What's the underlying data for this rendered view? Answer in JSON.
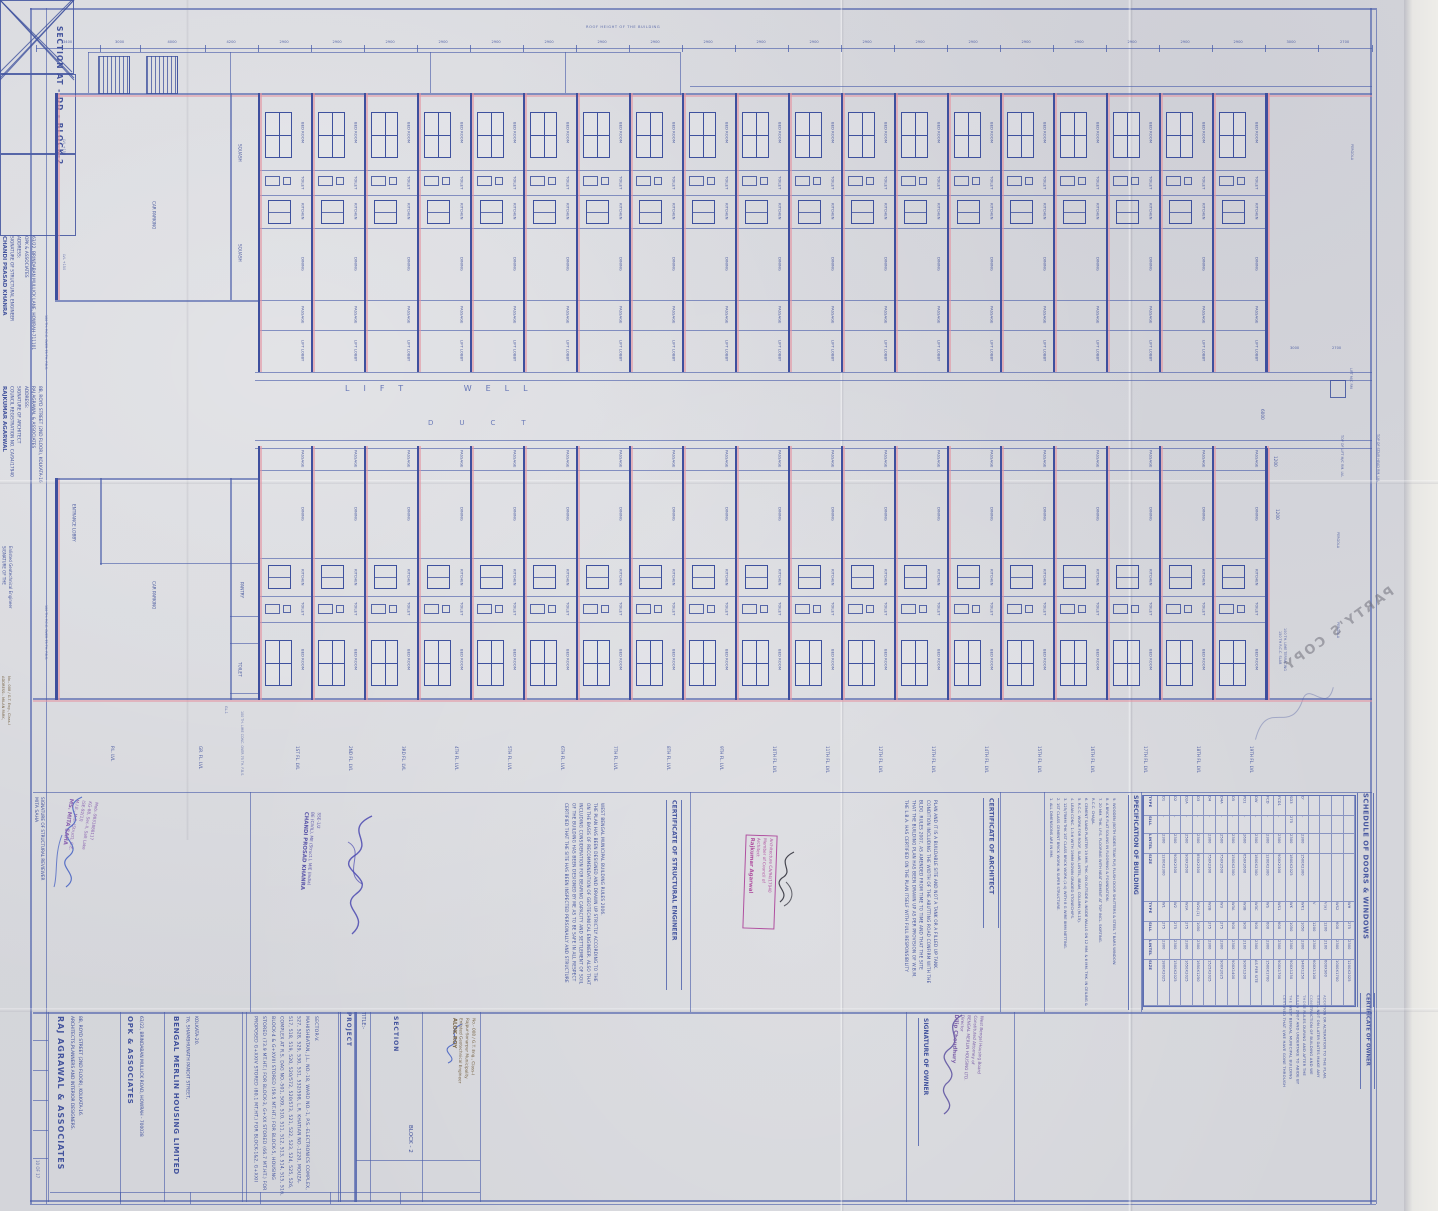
{
  "sheet": {
    "section_label": "SECTION AT - DD - BLOCK-2",
    "partys_copy": "PARTY'S COPY",
    "top_note": "ROOF HEIGHT OF THE BUILDING",
    "sheet_no": "10 OF 17"
  },
  "plan": {
    "floor_count": 19,
    "top_rooms": [
      "BED ROOM",
      "TOILET",
      "KITCHEN",
      "DINING",
      "PASSAGE",
      "LIFT LOBBY"
    ],
    "bottom_rooms": [
      "PASSAGE",
      "DINING",
      "KITCHEN",
      "TOILET",
      "BED ROOM"
    ],
    "shaft_labels": {
      "lift_well": "LIFT WELL",
      "duct": "DUCT"
    },
    "left_rooms": [
      "CAR PARKING",
      "SQUASH",
      "SQUASH",
      "ENTRANCE LOBBY",
      "CAR PARKING",
      "PANTRY",
      "TOILET"
    ],
    "left_levels": [
      "LVL +150",
      "LVL +150",
      "GL-1"
    ],
    "left_notes": [
      "100 TH. P.C.C. OVER 75 TH. F.B.S.",
      "100 TH. P.C.C. OVER 75 TH. F.B.S.",
      "100 TH. LIME CONC. OVER 75 TH. F.B.S."
    ],
    "right_labels": [
      "PERGOLA",
      "PERGOLA",
      "PERGOLA",
      "LIFT M/C RM",
      "TOP OF LIFT M/C RM. LVL",
      "TOP OF STAIR HEAD RM. LVL",
      "150 TH R.C.C. SLAB",
      "100 TH. LIME TERRACING"
    ],
    "pre_levels": [
      "P.L. LVL",
      "GR. FL. LVL"
    ],
    "floor_levels": [
      "1ST FL. LVL",
      "2ND FL. LVL",
      "3RD FL. LVL",
      "4TH FL. LVL",
      "5TH FL. LVL",
      "6TH FL. LVL",
      "7TH FL. LVL",
      "8TH FL. LVL",
      "9TH FL. LVL",
      "10TH FL. LVL",
      "11TH FL. LVL",
      "12TH FL. LVL",
      "13TH FL. LVL",
      "14TH FL. LVL",
      "15TH FL. LVL",
      "16TH FL. LVL",
      "17TH FL. LVL",
      "18TH FL. LVL",
      "19TH FL. LVL"
    ],
    "dims_top": [
      "3400",
      "3000",
      "4000",
      "4200",
      "2900",
      "2900",
      "2900",
      "2900",
      "2900",
      "2900",
      "2900",
      "2900",
      "2900",
      "2900",
      "2900",
      "2900",
      "2900",
      "2900",
      "2900",
      "2900",
      "2900",
      "2900",
      "2900",
      "3000",
      "2700"
    ],
    "dims_right": [
      "3000",
      "2700",
      "6000",
      "1200",
      "1200"
    ]
  },
  "schedule": {
    "title": "SCHEDULE OF DOORS & WINDOWS",
    "headers": [
      "TYPE",
      "SILL",
      "LINTEL",
      "SIZE",
      "TYPE",
      "SILL",
      "LINTEL",
      "SIZE"
    ],
    "rows": [
      [
        "D1",
        "-",
        "2300",
        "1200X2300",
        "W1",
        "275",
        "2300",
        "1800X2025"
      ],
      [
        "D2",
        "-",
        "2300",
        "900X2300",
        "W2",
        "275",
        "2300",
        "1500X2025"
      ],
      [
        "D2A",
        "-",
        "2500",
        "900X2500",
        "W2A",
        "275",
        "2300",
        "1650X2025"
      ],
      [
        "D3",
        "-",
        "2300",
        "850X2300",
        "W2A(1)",
        "1050",
        "2300",
        "1650X1250"
      ],
      [
        "D4",
        "-",
        "2300",
        "750X2300",
        "W2B",
        "275",
        "2300",
        "1525X2025"
      ],
      [
        "D4A",
        "-",
        "2500",
        "750X2500",
        "W3",
        "275",
        "2300",
        "900X2025"
      ],
      [
        "D5",
        "-",
        "2300",
        "1500X2300",
        "W3A",
        "900",
        "2300",
        "900X1400"
      ],
      [
        "PD1",
        "-",
        "2600",
        "650X2600",
        "W3B",
        "900",
        "2100",
        "900X1200"
      ],
      [
        "DW",
        "-",
        "2300",
        "1800X2300",
        "W3C",
        "900",
        "2300",
        "AS PER SITE"
      ],
      [
        "FCD",
        "-",
        "2300",
        "1200X2300",
        "WS",
        "600",
        "2300",
        "1500X1700"
      ],
      [
        "FCD1",
        "-",
        "2300",
        "900X2300",
        "WS1",
        "600",
        "2300",
        "900X1700"
      ],
      [
        "SD3",
        "275",
        "2300",
        "1800X2025",
        "WK",
        "1050",
        "2300",
        "900X1250"
      ],
      [
        "D'",
        "-",
        "2300",
        "1500X2300",
        "WK1",
        "1050",
        "2300",
        "940X1250"
      ],
      [
        "",
        "",
        "",
        "",
        "V",
        "1200",
        "2300",
        "600X1100"
      ],
      [
        "",
        "",
        "",
        "",
        "V(a)",
        "1200",
        "2100",
        "600X900"
      ],
      [
        "",
        "",
        "",
        "",
        "WS2",
        "600",
        "2300",
        "1000X1700"
      ],
      [
        "",
        "",
        "",
        "",
        "WH",
        "275",
        "2300",
        "1200X2025"
      ]
    ]
  },
  "specification": {
    "title": "SPECIFICATION OF BUILDING",
    "items": [
      "1. ALL DIMENSIONS ARE IN MM.",
      "2. 1ST CLASS CEMENT BRICK WORK IN SUPER STRUCTURE.",
      "3. 125/75MM THK 1ST CLASS BRICK WORK (1:4) WITH 8 G WIRE 8MM NETTING.",
      "4. LEAN CONC. 1:3:6 WITH 19MM DOWN GRADED STONECHIPS.",
      "5. R.C.C. WORK FOR ROOF, SLAB, LINTEL, BEAM, COLUMN (M-15).",
      "6. CEMENT SAND PLASTER 19 MM. THK. ON OUTSIDE & INSIDE WALLS ON 12 MM. & 6 MM. THK. IN CEILING & R.C.C. CHAJJA.",
      "7. 20 MM. THK. I.P.S. FLOORING WITH NEAT CEMENT AT TOP INCL. SKIRTING.",
      "8. A BRICK FLAT SOLING IN FLOORING & FOUNDATION.",
      "9. WOODEN (BOTH SIDES TEAK PLY) FLUSH DOOR SHUTTERS & STEEL T BARS WINDOW."
    ]
  },
  "certificates": {
    "structural_engineer": {
      "title": "CERTIFICATE OF STRUCTURAL ENGINEER",
      "text": "CERTIFIED THAT THE SITE HAS BEEN INSPECTED PERSONALLY AND STRUCTURE OF THE BUILDING HAS BEEN DESIGNED BY ME AS TO BE SAFE IN ALL RESPECT INCLUDING CONSIDERATION FOR BEARING CAPACITY AND SETTLEMENT OF SOIL ON THE BASIS OF RECOMMENDATION OF GEOTECHNICAL ENGINEER. ALSO THAT THE PLAN HAS BEEN DESIGNED AND DRAWN UP STRICTLY ACCORDING TO THE WEST BENGAL MUNICIPAL BUILDING RULES 2006."
    },
    "architect": {
      "title": "CERTIFICATE OF ARCHITECT",
      "text": "THE L.B.A. HAS CERTIFIED ON THE PLAN ITSELF WITH FULL RESPONSIBILITY THAT THE BUILDING PLAN HAS BEEN DRAWN UP AS PER PROVISION OF W.B.M. BLDG. RULES 2007, AS AMENDED FROM TIME TO TIME AND THAT THE SITE CONDITION INCLUDING THE WIDTH OF THE ABUTTING ROAD CONFIRM WITH THE PLAN AND IT IS A BUILDABLE SITE AND NOT A TANK OR A FILLED UP TANK."
    },
    "owner": {
      "title": "CERTIFICATE OF OWNER",
      "text": "CERTIFIED THAT I/WE HAVE GONE THROUGH THE WEST BENGAL MUNICIPAL BUILDING RULES 2007 AND UNDERTAKE TO ABIDE BY THOSE RULES DURING AND AFTER THE CONSTRUCTION OF BUILDING AND WE SHALL NOT ON LATER DATES MAKE ANY ADDITION OR ALTERATION TO THE PLAN."
    }
  },
  "signatures": {
    "reviewer": {
      "name": "MITA SAHA",
      "label": "SIGNATURE OF STRUCTURAL REVIEWER",
      "stamp": [
        "MS. MITA SAHA",
        "M.I.E., M.E. (Struct), C.E.",
        "(SE-92(1))",
        "KG-88, Sec-II, Salt Lake",
        "Mob:-9831888117"
      ]
    },
    "structural_engineer": {
      "lines": [
        "CHANDI PRASAD KHANRA",
        "SIGNATURE OF STRUCTURAL ENGINEER",
        "ADDRESS:",
        "OPK & ASSOCIATES",
        "63/22, BRINDABAN MULLICK LANE, HOWRAH-711101"
      ],
      "stamp": [
        "CHANDI PROSAD KHANRA",
        "BE (CIVIL), ME (Struct.), MIE (India)",
        "SSE-1/2"
      ]
    },
    "architect": {
      "lines": [
        "RAJKUMAR AGARWAL",
        "COUNCIL REGISTRATION NO. CA/94/17940",
        "SIGNATURE OF ARCHITECT",
        "ADDRESS:",
        "RAJ AGRAWAL & ASSOCIATES",
        "8B, ROYD STREET (2ND FLOOR), KOLKATA-16"
      ],
      "stamp": [
        "Rajkumar Agarwal",
        "Architect",
        "Member of Council of",
        "Architecture CA/94/17940"
      ]
    },
    "geotech": {
      "label_lines": [
        "SIGNATURE OF THE",
        "Enlisted Geotechnical Engineer"
      ],
      "address_lines": [
        "ADDRESS:- MILAN PARK,",
        "No.- 008 / G.T. Eng., Class-I"
      ],
      "stamp": [
        "ALOK ROY",
        "Enlisted Geotechnical Engineer",
        "Rajpur-Sonarpur Municipality",
        "No.- 008 / G.T. Eng., Class-I"
      ]
    },
    "owner": {
      "label": "SIGNATURE OF OWNER",
      "stamp": [
        "Dilip Choudhury",
        "Director",
        "BENGAL MERLIN HOUSING LTD.",
        "Constituted Attorney of",
        "West Bengal Housing Board"
      ]
    }
  },
  "title_block": {
    "architect_firm": {
      "name": "RAJ AGRAWAL & ASSOCIATES",
      "subtitle": "ARCHITECTS,PLANNERS AND INTERIOR DESIGNERS.",
      "address": "8B, ROYD STREET (2ND FLOOR), KOLKATA-16."
    },
    "structural_firm": {
      "name": "OPK & ASSOCIATES",
      "address": "63/22, BRINDABAN MULLICK ROAD, HOWRAH - 700038"
    },
    "client": {
      "name": "BENGAL MERLIN HOUSING LIMITED",
      "address1": "76, SHAMBHUNATH PANDIT STREET,",
      "address2": "KOLKATA-20."
    },
    "project_label": "PROJECT",
    "project_text": "PROPOSED G+XXIV STORED (80.1 MT.HT.) FOR BLOCK-1&2, G+XXII STORED (73.9 MT.HT.) FOR BLOCK-3, G+XX STORED (66.7 MT.HT.) FOR BLOCK-4 & G+XVIII STORED (59.5 MT.HT.) FOR BLOCK-5, HOUSING COMPLEX AT R.S. DAG NO.-501, 509, 510, 511, 512, 513, 514, 515, 516, 517, 518, 519, 520, 520/572, 520/573, 521, 522, 523, 524, 525, 526, 527, 528, 529, 530, 531, 532/598, L.R. KHATIAN NO.-1220, MOUZA- MAHISHBATAN, J.L. NO.-18, WARD NO.-1, P.S.-ELECTRONICS COMPLEX, SECTOR-V.",
    "title_label": "TITLE:-",
    "title_text": "SECTION",
    "block_text": "BLOCK - 2"
  }
}
